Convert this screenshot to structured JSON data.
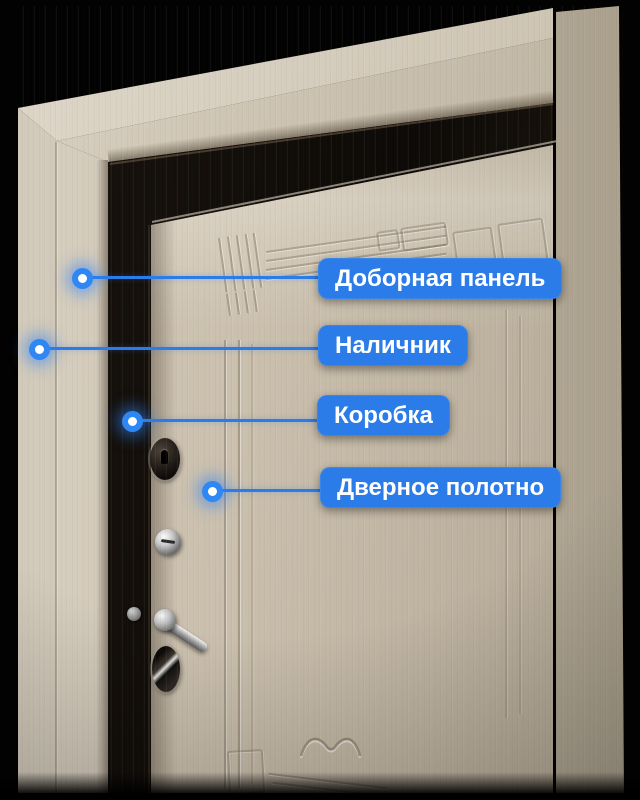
{
  "annotation": {
    "accent_color": "#2b7ce8",
    "dot_color": "#2f87f3",
    "text_color": "#ffffff",
    "labels": [
      {
        "text": "Доборная панель",
        "target": "extension-panel"
      },
      {
        "text": "Наличник",
        "target": "casing"
      },
      {
        "text": "Коробка",
        "target": "frame-box"
      },
      {
        "text": "Дверное полотно",
        "target": "door-leaf"
      }
    ]
  },
  "scene": {
    "subject": "entrance-door-photo",
    "background_color": "#000000"
  }
}
